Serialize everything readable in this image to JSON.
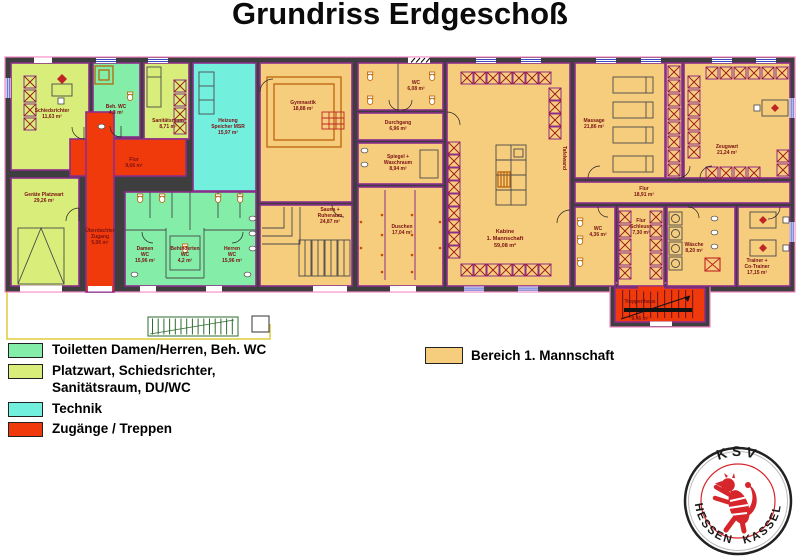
{
  "title": "Grundriss Erdgeschoß",
  "legend": {
    "items": [
      {
        "label": "Toiletten Damen/Herren, Beh. WC",
        "color": "#84EDA8"
      },
      {
        "label": "Platzwart, Schiedsrichter,",
        "label2": "Sanitätsraum, DU/WC",
        "color": "#D9EE7A"
      },
      {
        "label": "Technik",
        "color": "#73EFDE"
      },
      {
        "label": "Zugänge / Treppen",
        "color": "#F13A0C"
      }
    ],
    "bereich": {
      "label": "Bereich 1. Mannschaft",
      "color": "#F6CC7D"
    }
  },
  "rooms": {
    "schiedsrichter": {
      "name": "Schiedsrichter",
      "area": "11,63 m²"
    },
    "beh_wc": {
      "name": "Beh. WC",
      "area": "4,3 m²"
    },
    "sanitaetsraum": {
      "name": "Sanitätsraum",
      "area": "8,71 m²"
    },
    "heizung": {
      "name1": "Heizung",
      "name2": "Speicher MSR",
      "area": "15,97 m²"
    },
    "flur_links": {
      "name": "Flur",
      "area": "9,66 m²"
    },
    "geraete_platzwart": {
      "name": "Geräte Platzwart",
      "area": "29,26 m²"
    },
    "ueberdachter_zugang": {
      "name1": "Überdachter",
      "name2": "Zugang",
      "area": "5,06 m²"
    },
    "damen_wc": {
      "name1": "Damen",
      "name2": "WC",
      "area": "15,96 m²"
    },
    "behinderten_wc": {
      "name1": "Behinderten",
      "name2": "WC",
      "area": "4,2 m²"
    },
    "herren_wc": {
      "name1": "Herren",
      "name2": "WC",
      "area": "15,96 m²"
    },
    "gymnastik": {
      "name": "Gymnastik",
      "area": "18,88 m²"
    },
    "sauna": {
      "name1": "Sauna +",
      "name2": "Ruheraum",
      "area": "24,87 m²"
    },
    "wc_mitte": {
      "name": "WC",
      "area": "6,08 m²"
    },
    "durchgang": {
      "name": "Durchgang",
      "area": "6,96 m²"
    },
    "spiegel": {
      "name1": "Spiegel +",
      "name2": "Waschraum",
      "area": "8,94 m²"
    },
    "duschen": {
      "name": "Duschen",
      "area": "17,04 m²"
    },
    "kabine": {
      "name1": "Kabine",
      "name2": "1. Mannschaft",
      "area": "59,08 m²"
    },
    "tafelwand": {
      "name": "Tafelwand"
    },
    "massage": {
      "name": "Massage",
      "area": "21,86 m²"
    },
    "flur_rechts": {
      "name": "Flur",
      "area": "18,91 m²"
    },
    "zeugwart": {
      "name": "Zeugwart",
      "area": "21,24 m²"
    },
    "wc_rechts": {
      "name": "WC",
      "area": "4,36 m²"
    },
    "flur_schleuse": {
      "name1": "Flur",
      "name2": "Schleuse",
      "area": "7,30 m²"
    },
    "waesche": {
      "name": "Wäsche",
      "area": "8,20 m²"
    },
    "trainer": {
      "name1": "Trainer +",
      "name2": "Co-Trainer",
      "area": "17,15 m²"
    },
    "treppenhaus": {
      "name": "Treppenhaus",
      "area": "9,46 m²"
    }
  },
  "logo": {
    "top": "KSV",
    "bottom_left": "HESSEN",
    "bottom_right": "KASSEL"
  },
  "colors": {
    "wall": "#3E3E3E",
    "bereich_tan": "#F6CC7D",
    "toiletten_gruen": "#84EDA8",
    "platzwart_gelbgruen": "#D9EE7A",
    "technik_cyan": "#73EFDE",
    "zugang_rot": "#F13A0C",
    "wand_lila": "#8C2D8C",
    "aussen_pink": "#F389C5",
    "beschriftung_rot": "#7A1212",
    "logo_rot": "#D6262C",
    "fenster_blau": "#2233BB",
    "weg_gelb": "#DECB3A"
  }
}
